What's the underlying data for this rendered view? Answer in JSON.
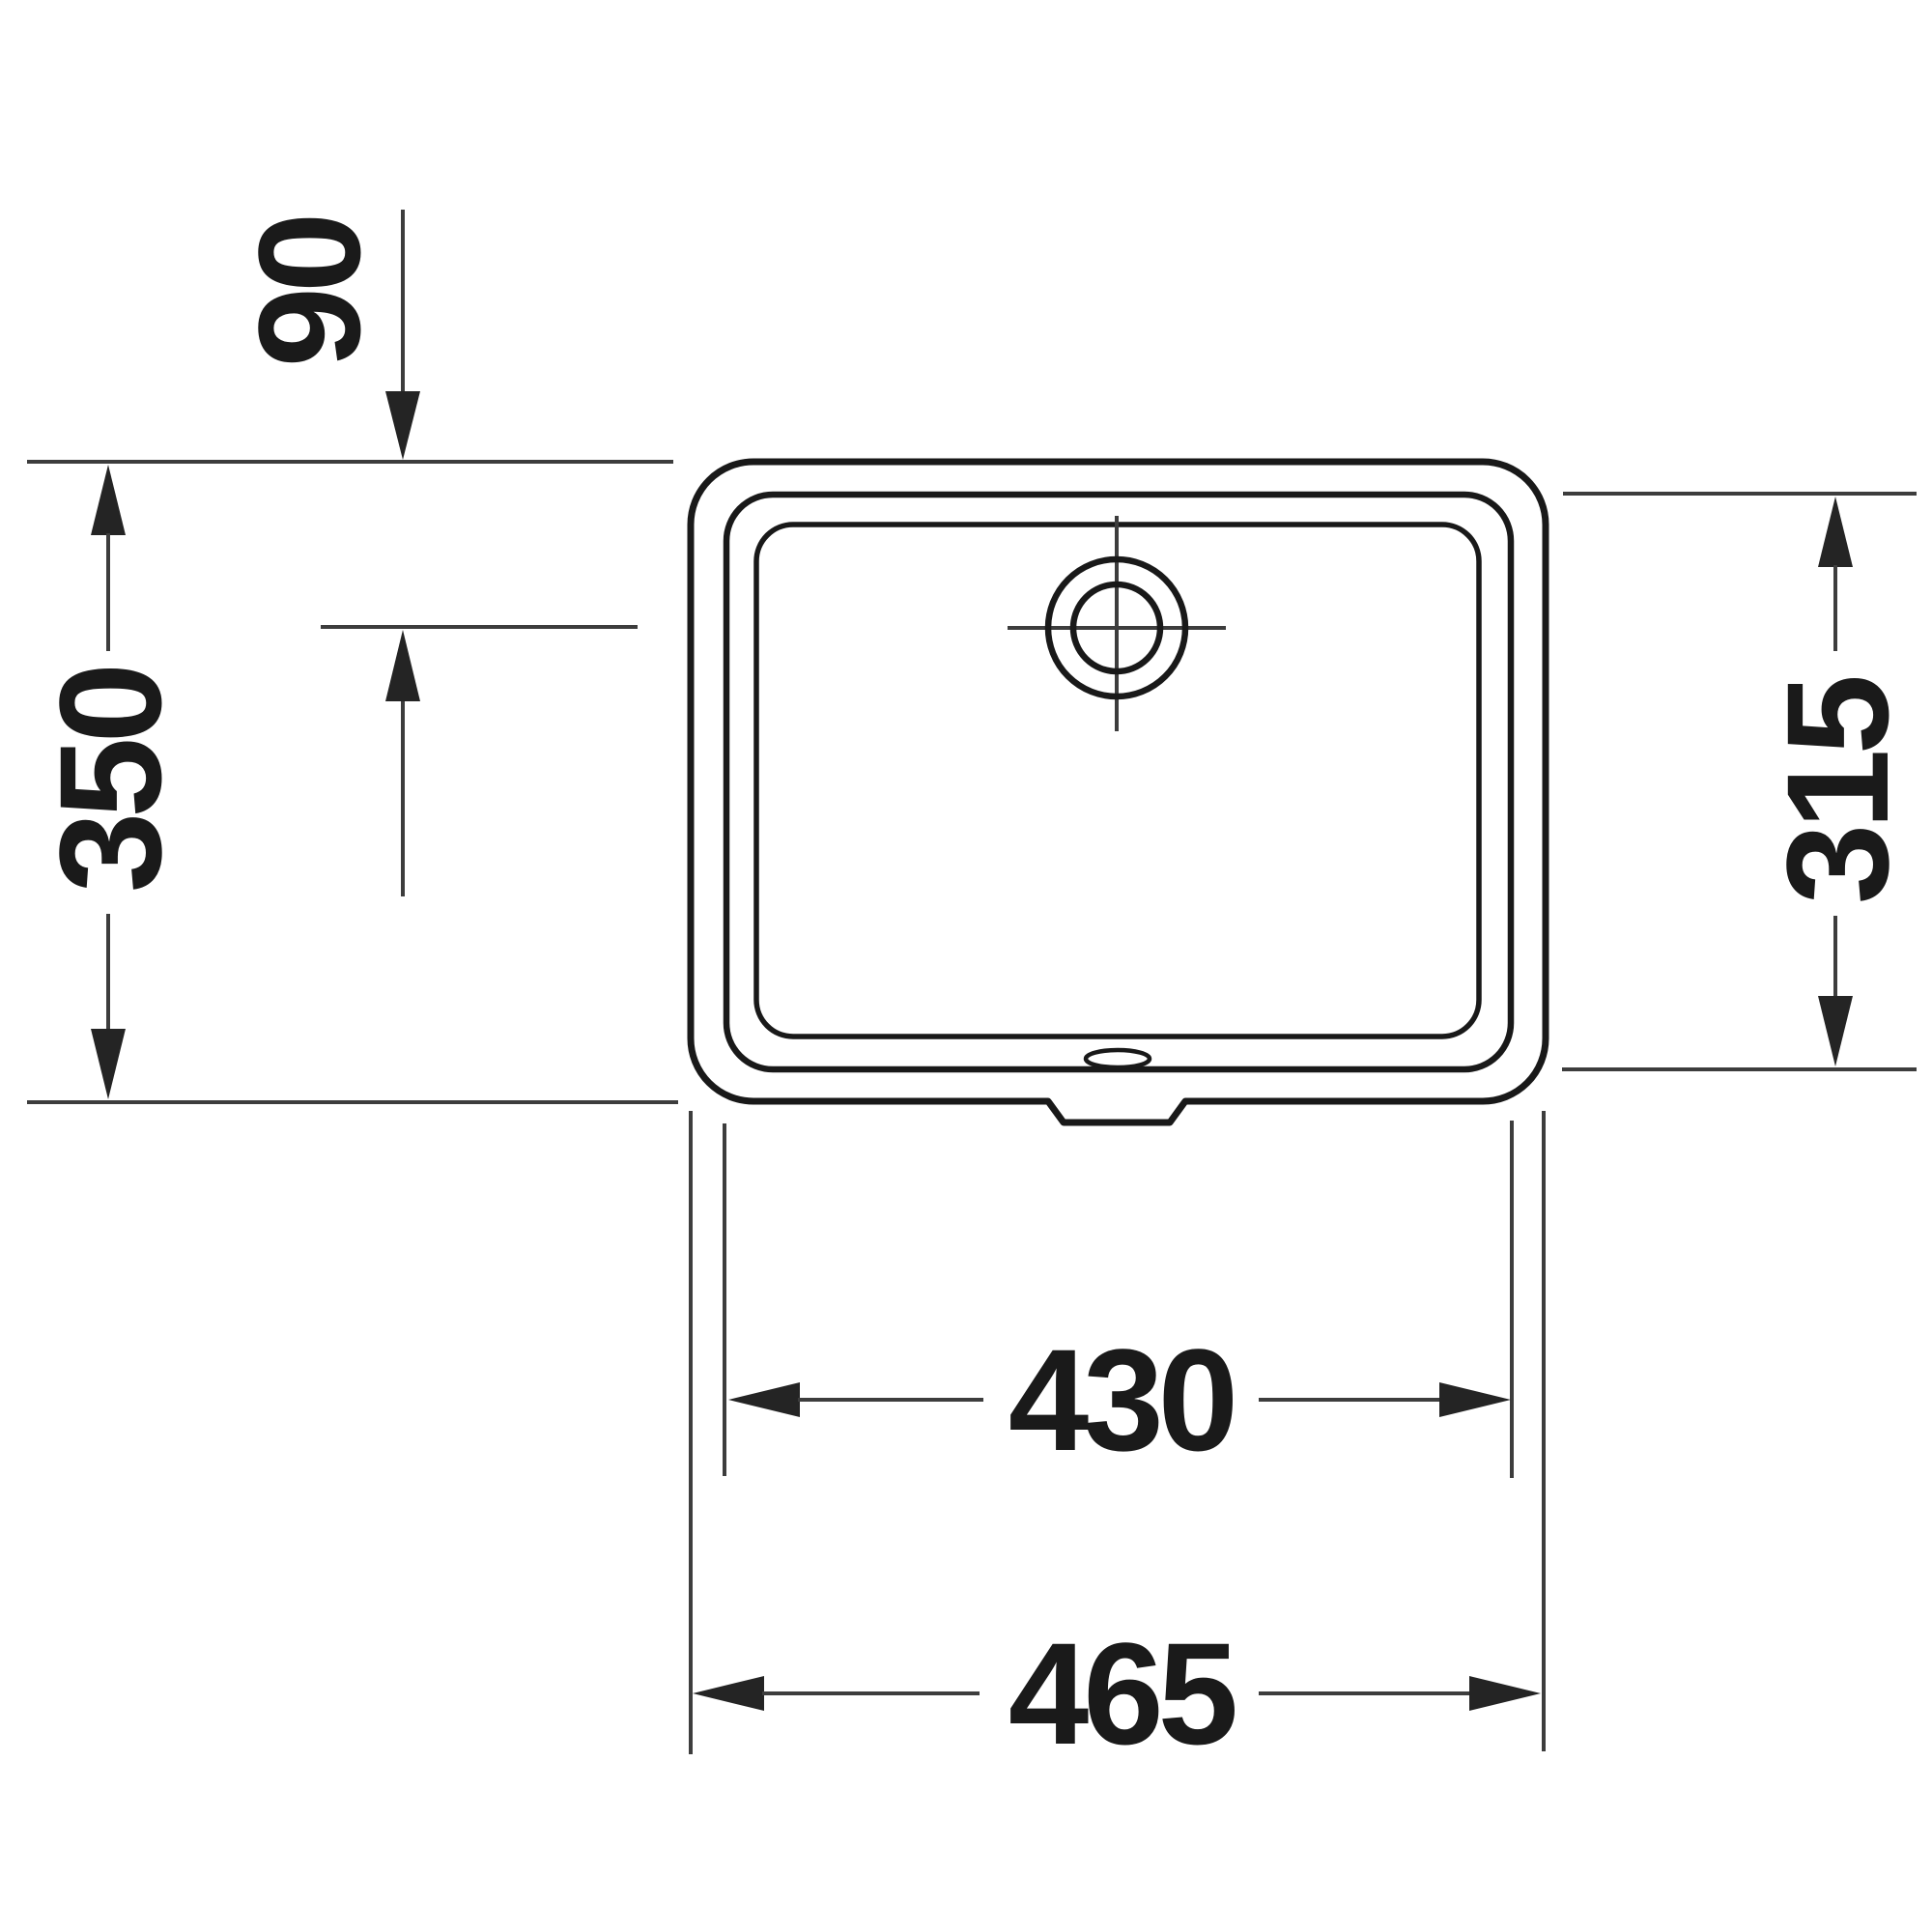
{
  "drawing": {
    "name": "undercounter-washbasin-plan-view-technical-drawing",
    "labels": {
      "dim_faucet_to_front": "90",
      "dim_outer_depth": "350",
      "dim_inner_depth": "315",
      "dim_inner_width": "430",
      "dim_outer_width": "465"
    },
    "colors": {
      "background": "#ffffff",
      "outline": "#191919",
      "thin_line": "#3d3d3d",
      "arrow": "#242424",
      "label_text": "#1a1a1a"
    }
  }
}
